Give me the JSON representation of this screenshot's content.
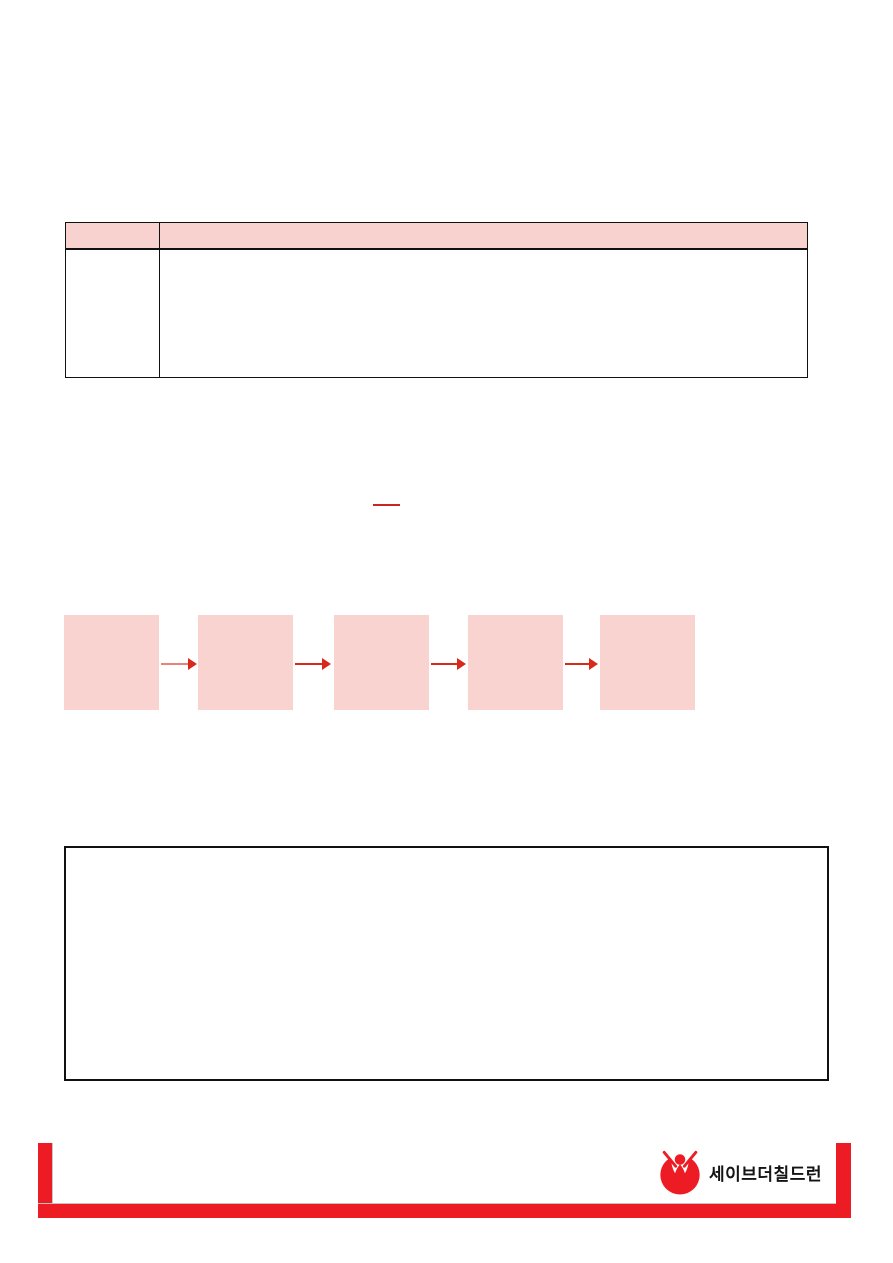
{
  "document": {
    "kind": "blank-template-page",
    "background": "#ffffff"
  },
  "colors": {
    "pink_fill": "#f8d3cf",
    "table_header_pink": "#f8d2cf",
    "brand_red": "#ed1c24",
    "arrow_red": "#d8291d",
    "arrow1_stem_red": "#e8837c",
    "underline_red": "#c7271c",
    "border_black": "#111111",
    "shadow_gray": "#c9c9c9"
  },
  "table": {
    "header": [
      "",
      ""
    ],
    "rows": [
      [
        "",
        ""
      ]
    ]
  },
  "inline": {
    "red_underlined_text": ""
  },
  "flowchart": {
    "steps": [
      {
        "label": ""
      },
      {
        "label": ""
      },
      {
        "label": ""
      },
      {
        "label": ""
      },
      {
        "label": ""
      }
    ]
  },
  "notes_box": {
    "content": ""
  },
  "footer": {
    "logo_text": "세이브더칠드런",
    "logo_icon": "save-the-children-child-in-circle-logo"
  }
}
